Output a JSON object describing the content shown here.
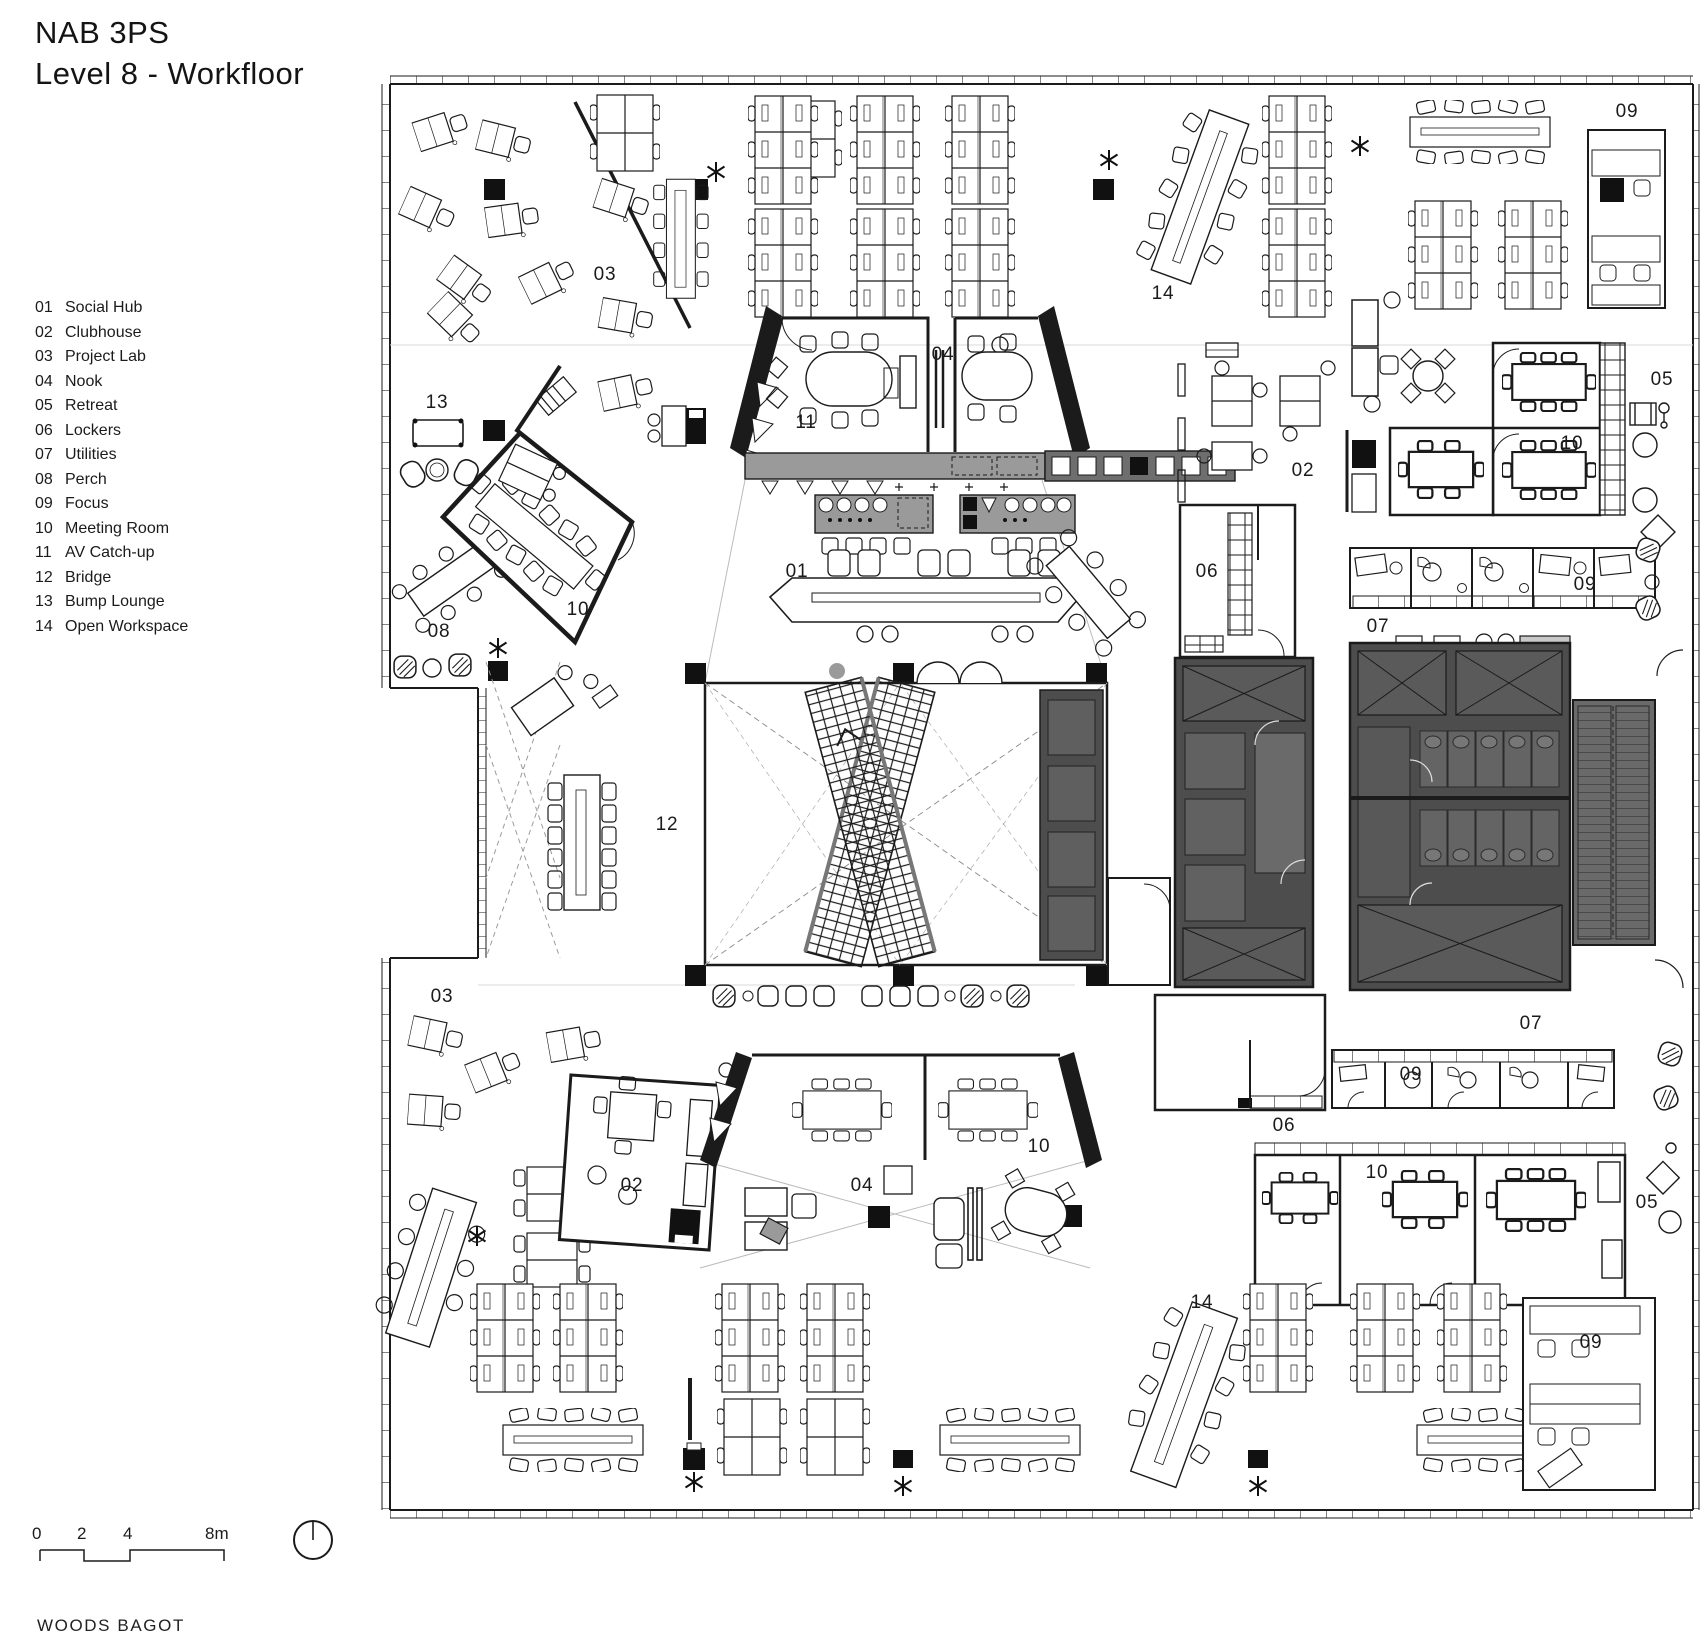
{
  "title": {
    "line1": "NAB 3PS",
    "line2": "Level 8 - Workfloor"
  },
  "legend": {
    "items": [
      {
        "num": "01",
        "label": "Social Hub"
      },
      {
        "num": "02",
        "label": "Clubhouse"
      },
      {
        "num": "03",
        "label": "Project Lab"
      },
      {
        "num": "04",
        "label": "Nook"
      },
      {
        "num": "05",
        "label": "Retreat"
      },
      {
        "num": "06",
        "label": "Lockers"
      },
      {
        "num": "07",
        "label": "Utilities"
      },
      {
        "num": "08",
        "label": "Perch"
      },
      {
        "num": "09",
        "label": "Focus"
      },
      {
        "num": "10",
        "label": "Meeting Room"
      },
      {
        "num": "11",
        "label": "AV Catch-up"
      },
      {
        "num": "12",
        "label": "Bridge"
      },
      {
        "num": "13",
        "label": "Bump Lounge"
      },
      {
        "num": "14",
        "label": "Open Workspace"
      }
    ]
  },
  "plan": {
    "room_labels": [
      {
        "text": "09"
      },
      {
        "text": "03"
      },
      {
        "text": "14"
      },
      {
        "text": "04"
      },
      {
        "text": "05"
      },
      {
        "text": "13"
      },
      {
        "text": "11"
      },
      {
        "text": "10"
      },
      {
        "text": "02"
      },
      {
        "text": "01"
      },
      {
        "text": "06"
      },
      {
        "text": "09"
      },
      {
        "text": "10"
      },
      {
        "text": "07"
      },
      {
        "text": "08"
      },
      {
        "text": "12"
      },
      {
        "text": "03"
      },
      {
        "text": "07"
      },
      {
        "text": "09"
      },
      {
        "text": "06"
      },
      {
        "text": "10"
      },
      {
        "text": "10"
      },
      {
        "text": "02"
      },
      {
        "text": "04"
      },
      {
        "text": "05"
      },
      {
        "text": "14"
      },
      {
        "text": "09"
      }
    ]
  },
  "scale_bar": {
    "t0": "0",
    "t1": "2",
    "t2": "4",
    "t3": "8m"
  },
  "footer": {
    "brand": "WOODS BAGOT"
  },
  "colors": {
    "ink": "#1b1b1b",
    "core_fill": "#4d4d4d",
    "counter_fill": "#9a9a9a"
  }
}
